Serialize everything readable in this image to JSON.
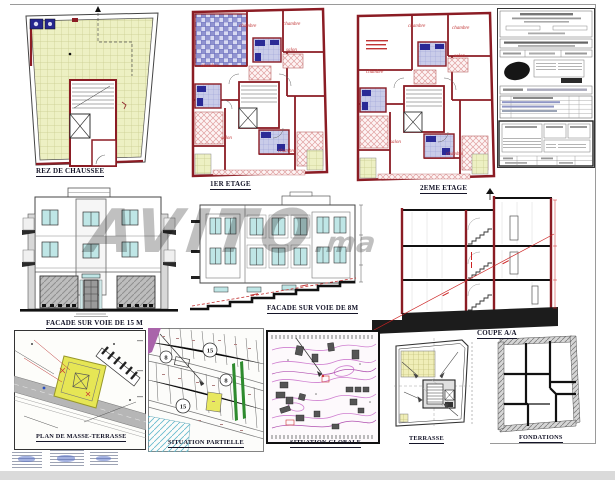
{
  "document": {
    "type_hint": "architectural plan sheet",
    "watermark": {
      "main": "AVITO",
      "suffix": ".ma"
    }
  },
  "plans": {
    "rez": {
      "label": "REZ DE CHAUSSEE"
    },
    "first": {
      "label": "1ER ETAGE",
      "rooms": [
        "chambre",
        "chambre",
        "chambre",
        "salon",
        "salon",
        "chambre"
      ]
    },
    "second": {
      "label": "2EME ETAGE",
      "rooms": [
        "chambre",
        "chambre",
        "salon",
        "salon",
        "chambre",
        "chambre"
      ]
    },
    "terrasse": {
      "label": "TERRASSE"
    },
    "fondations": {
      "label": "FONDATIONS"
    }
  },
  "elevations": {
    "facade15": {
      "label": "FACADE SUR VOIE DE 15 M"
    },
    "facade8": {
      "label": "FACADE SUR VOIE DE 8M"
    },
    "coupe": {
      "label": "COUPE A/A"
    }
  },
  "site": {
    "masse": {
      "label": "PLAN DE MASSE-TERRASSE"
    },
    "partielle": {
      "label": "SITUATION PARTIELLE",
      "circles": [
        "8",
        "15",
        "8",
        "15"
      ]
    },
    "globale": {
      "label": "SITUATION GLOBALE"
    }
  },
  "colors": {
    "wall_red": "#8b1c24",
    "window_cyan": "#bfe6e6",
    "floor_hatch_yellow": "#edf0c3",
    "terrace_blue": "#9093d0",
    "parcel_yellow": "#e6e655",
    "road_gray": "#b6b6b6",
    "contour_pink": "#cf7fd0",
    "green_strip": "#2e8b2e",
    "watermark_gray": "#828282"
  }
}
